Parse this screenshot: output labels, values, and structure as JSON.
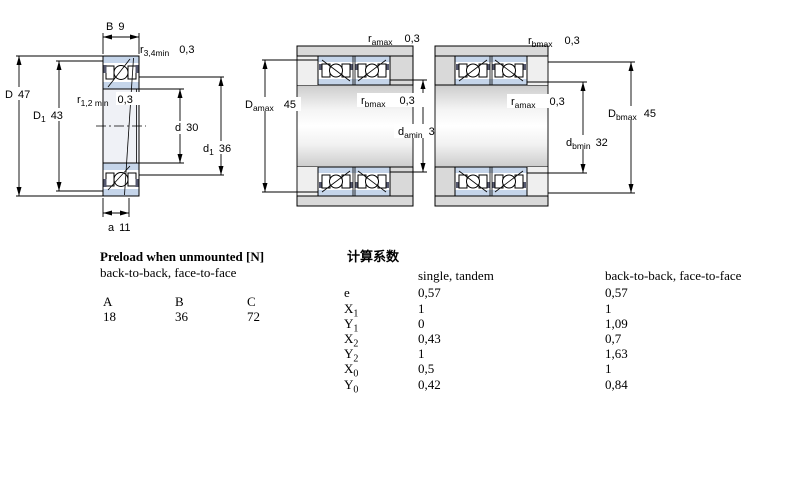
{
  "colors": {
    "bearing_ring_fill": "#c5d5ea",
    "housing_fill": "#d9d9d9",
    "shoulder_light_fill": "#efefef",
    "bore_tint": "#eff1f6",
    "seal_mark": "#55586e",
    "line": "#000000"
  },
  "left_diagram": {
    "labels": {
      "B": {
        "main": "B",
        "value": "9"
      },
      "r34": {
        "main": "r",
        "sub": "3,4min",
        "value": "0,3"
      },
      "D": {
        "main": "D",
        "value": "47"
      },
      "D1": {
        "main": "D",
        "sub": "1",
        "value": "43"
      },
      "r12": {
        "main": "r",
        "sub": "1,2 min",
        "value": "0,3"
      },
      "d": {
        "main": "d",
        "value": "30"
      },
      "d1": {
        "main": "d",
        "sub": "1",
        "value": "36"
      },
      "a": {
        "main": "a",
        "value": "11"
      }
    }
  },
  "middle_diagram": {
    "labels": {
      "ramax": {
        "main": "r",
        "sub": "amax",
        "value": "0,3"
      },
      "Damax": {
        "main": "D",
        "sub": "amax",
        "value": "45"
      },
      "rbmax": {
        "main": "r",
        "sub": "bmax",
        "value": "0,3"
      },
      "damin": {
        "main": "d",
        "sub": "amin",
        "value": "32"
      }
    }
  },
  "right_diagram": {
    "labels": {
      "rbmax": {
        "main": "r",
        "sub": "bmax",
        "value": "0,3"
      },
      "ramax": {
        "main": "r",
        "sub": "amax",
        "value": "0,3"
      },
      "dbmin": {
        "main": "d",
        "sub": "bmin",
        "value": "32"
      },
      "Dbmax": {
        "main": "D",
        "sub": "bmax",
        "value": "45"
      }
    }
  },
  "preload_table": {
    "title": "Preload when unmounted [N]",
    "subtitle": "back-to-back, face-to-face",
    "columns": [
      "A",
      "B",
      "C"
    ],
    "values": [
      "18",
      "36",
      "72"
    ]
  },
  "factors_table": {
    "title": "计算系数",
    "col_single": "single, tandem",
    "col_btb": "back-to-back, face-to-face",
    "rows": [
      {
        "main": "e",
        "sub": "",
        "single": "0,57",
        "btb": "0,57"
      },
      {
        "main": "X",
        "sub": "1",
        "single": "1",
        "btb": "1"
      },
      {
        "main": "Y",
        "sub": "1",
        "single": "0",
        "btb": "1,09"
      },
      {
        "main": "X",
        "sub": "2",
        "single": "0,43",
        "btb": "0,7"
      },
      {
        "main": "Y",
        "sub": "2",
        "single": "1",
        "btb": "1,63"
      },
      {
        "main": "X",
        "sub": "0",
        "single": "0,5",
        "btb": "1"
      },
      {
        "main": "Y",
        "sub": "0",
        "single": "0,42",
        "btb": "0,84"
      }
    ]
  }
}
